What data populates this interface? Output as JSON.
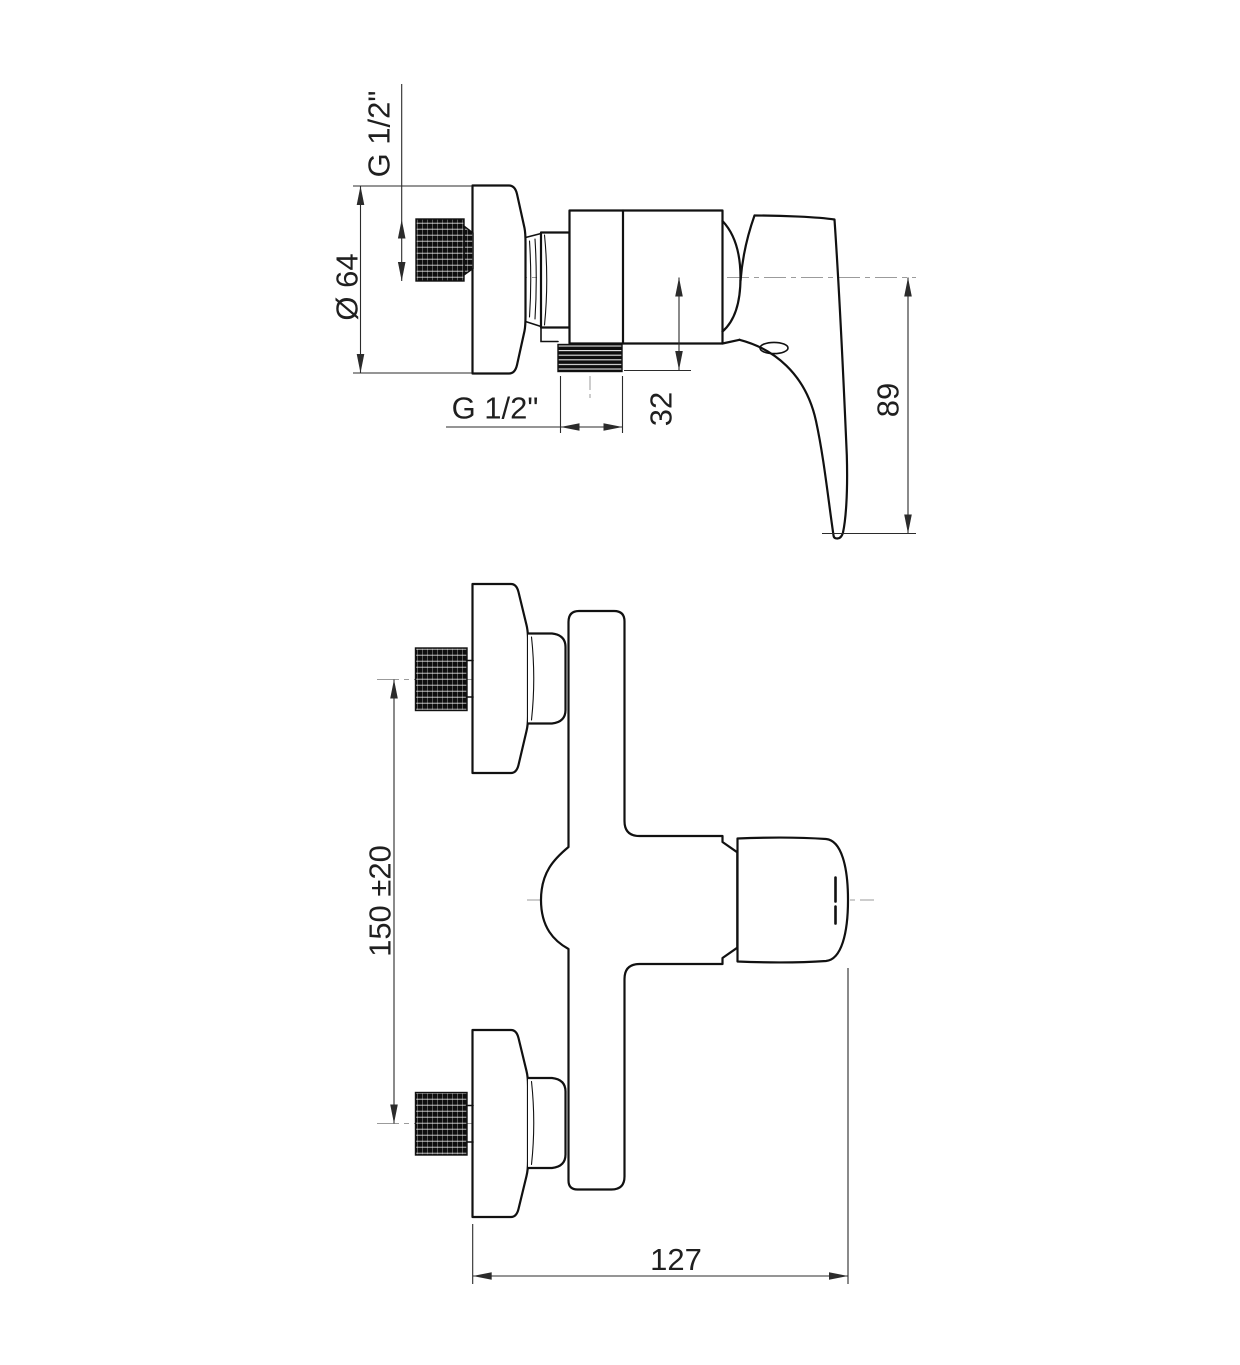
{
  "drawing": {
    "side_view": {
      "inlet_thread_label": "G 1/2\"",
      "escutcheon_diameter_label": "Ø 64",
      "outlet_thread_label": "G 1/2\"",
      "outlet_offset_label": "32",
      "handle_drop_label": "89"
    },
    "front_view": {
      "centres_label": "150 ±20",
      "width_label": "127"
    }
  }
}
